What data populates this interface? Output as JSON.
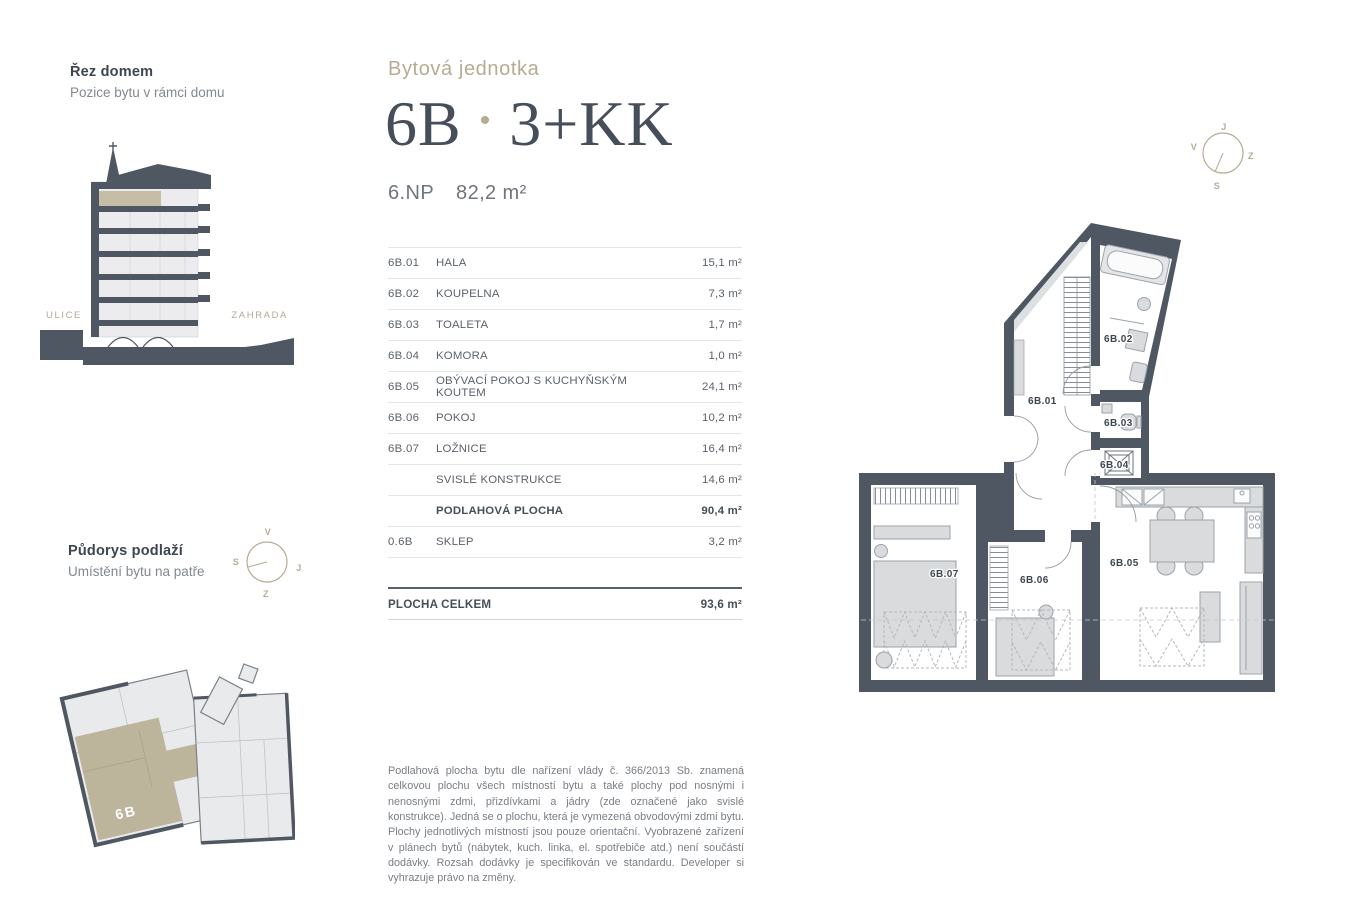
{
  "colors": {
    "wall": "#4f5862",
    "accent_tan": "#b5ac93",
    "highlight_beige": "#c6bda6"
  },
  "section_view": {
    "title": "Řez domem",
    "subtitle": "Pozice bytu v rámci domu",
    "street_label": "ULICE",
    "garden_label": "ZAHRADA"
  },
  "unit": {
    "eyebrow": "Bytová jednotka",
    "code": "6B",
    "separator": "•",
    "layout": "3+KK",
    "floor": "6.NP",
    "area": "82,2 m²"
  },
  "rooms_table": {
    "rows": [
      {
        "code": "6B.01",
        "name": "HALA",
        "area": "15,1 m²"
      },
      {
        "code": "6B.02",
        "name": "KOUPELNA",
        "area": "7,3 m²"
      },
      {
        "code": "6B.03",
        "name": "TOALETA",
        "area": "1,7 m²"
      },
      {
        "code": "6B.04",
        "name": "KOMORA",
        "area": "1,0 m²"
      },
      {
        "code": "6B.05",
        "name": "OBÝVACÍ POKOJ S KUCHYŇSKÝM KOUTEM",
        "area": "24,1 m²"
      },
      {
        "code": "6B.06",
        "name": "POKOJ",
        "area": "10,2 m²"
      },
      {
        "code": "6B.07",
        "name": "LOŽNICE",
        "area": "16,4 m²"
      },
      {
        "code": "",
        "name": "SVISLÉ KONSTRUKCE",
        "area": "14,6 m²"
      },
      {
        "code": "",
        "name": "PODLAHOVÁ PLOCHA",
        "area": "90,4 m²"
      },
      {
        "code": "0.6B",
        "name": "SKLEP",
        "area": "3,2 m²"
      }
    ],
    "total_label": "PLOCHA CELKEM",
    "total_area": "93,6 m²"
  },
  "floor_plan": {
    "labels": {
      "r01": "6B.01",
      "r02": "6B.02",
      "r03": "6B.03",
      "r04": "6B.04",
      "r05": "6B.05",
      "r06": "6B.06",
      "r07": "6B.07"
    }
  },
  "compass_plan": {
    "top": "J",
    "left": "V",
    "right": "Z",
    "bottom": "S"
  },
  "compass_floor": {
    "top": "V",
    "left": "S",
    "right": "J",
    "bottom": "Z"
  },
  "floor_overview": {
    "title": "Půdorys podlaží",
    "subtitle": "Umístění bytu na patře",
    "unit_label": "6B"
  },
  "disclaimer": {
    "text": "Podlahová plocha bytu dle nařízení vlády č. 366/2013 Sb. znamená celkovou plochu všech místností bytu a také plochy pod nosnými i nenosnými zdmi, přizdívkami a jádry (zde označené jako svislé konstrukce). Jedná se o plochu, která je vymezená obvodovými zdmi bytu. Plochy jednotlivých místností jsou pouze orientační. Vyobrazené zařízení v plánech bytů (nábytek, kuch. linka, el. spotřebiče atd.) není součástí dodávky. Rozsah dodávky je specifikován ve standardu. Developer si vyhrazuje právo na změny."
  }
}
